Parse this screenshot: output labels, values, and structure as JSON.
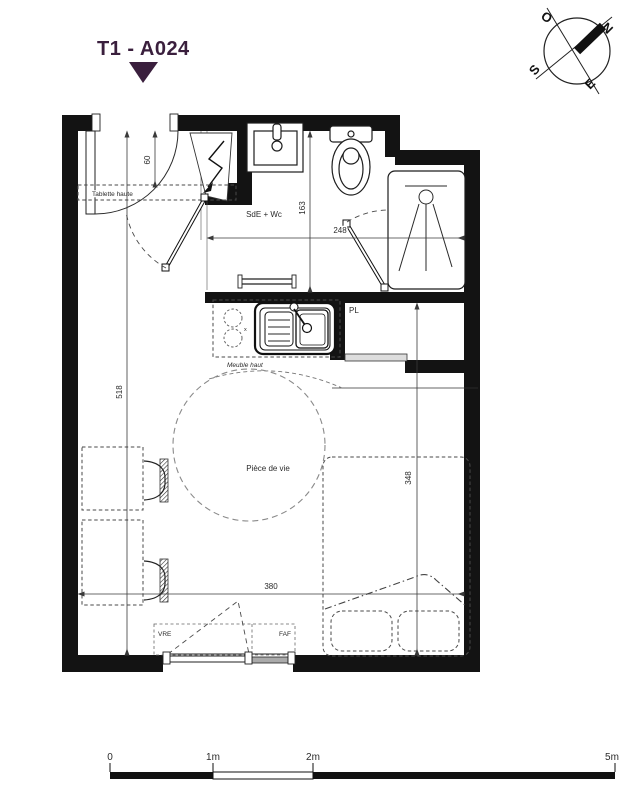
{
  "title": {
    "text": "T1 - A024"
  },
  "compass": {
    "o": "O",
    "n": "N",
    "s": "S",
    "e": "E"
  },
  "rooms": {
    "bathroom": "SdE + Wc",
    "living": "Pièce de vie",
    "closet": "PL"
  },
  "annotations": {
    "shelf": "Tablette haute",
    "upper_cabinet": "Meuble haut",
    "window_left": "VRE",
    "window_right": "FAF",
    "kitchen_mark": "x"
  },
  "dimensions": {
    "entry_depth": "60",
    "bathroom_width": "163",
    "bathroom_length": "248",
    "apartment_depth": "518",
    "bed_width": "348",
    "living_width": "380"
  },
  "scale_bar": {
    "zero": "0",
    "one": "1m",
    "two": "2m",
    "five": "5m"
  },
  "colors": {
    "accent": "#3A1F3D",
    "line": "#131313"
  }
}
